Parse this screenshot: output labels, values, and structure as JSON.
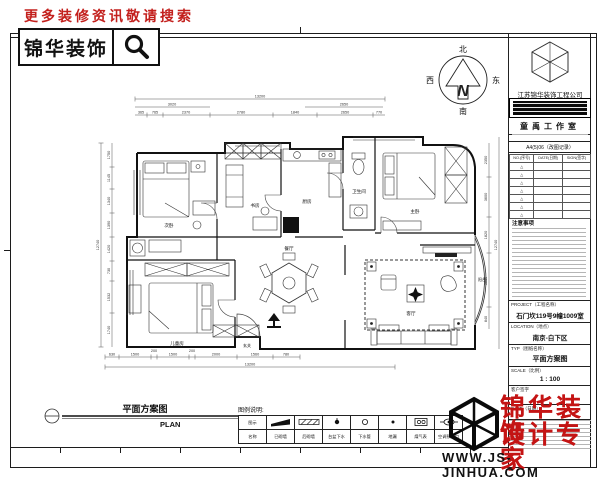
{
  "header": {
    "promo": "更多装修资讯敬请搜索",
    "brand": "锦华装饰"
  },
  "compass": {
    "north": "北",
    "south": "南",
    "east": "东",
    "west": "西",
    "letter": "N"
  },
  "titleblock": {
    "company": "江苏锦华装饰工程公司",
    "studio": "童禹工作室",
    "revision_title": "A4(5)06（改图记录）",
    "rev_headers": [
      "NO.(序号)",
      "DATE(日期)",
      "SIGN(签字)"
    ],
    "rev_mark": "△",
    "notes_title": "注意事项",
    "fields": [
      {
        "label": "PROJECT（工程名称）",
        "value": "石门坎119号9幢1009室"
      },
      {
        "label": "LOCATION（地点）",
        "value": "南京-白下区"
      },
      {
        "label": "TYP（图纸名称）",
        "value": "平面方案图"
      },
      {
        "label": "SCALE（比例）",
        "value": "1 : 100"
      },
      {
        "label": "客户签字",
        "value": ""
      },
      {
        "label": "DATE（日期）",
        "value": ""
      }
    ]
  },
  "plan": {
    "sheet_title": "平面方案图",
    "sheet_title_en": "PLAN",
    "rooms": {
      "bed2": "次卧",
      "study": "书房",
      "kitchen": "厨房",
      "bath": "卫生间",
      "master": "主卧",
      "balcony": "阳台",
      "child": "儿童房",
      "dining": "餐厅",
      "living": "客厅",
      "entry": "玄关"
    },
    "dims": {
      "top_total": "13200",
      "top_mid": [
        "3020",
        "2650"
      ],
      "top_segs": [
        "365",
        "765",
        "2370",
        "2780",
        "1840",
        "2650",
        "770"
      ],
      "left_total": "12740",
      "left_segs": [
        "1750",
        "1145",
        "1340",
        "1390",
        "1420",
        "730",
        "1532",
        "1740"
      ],
      "right_total": "12740",
      "right_segs": [
        "2350",
        "3600",
        "1820",
        "3610",
        "840"
      ],
      "bottom_total": "13200",
      "bottom_segs": [
        "630",
        "1500",
        "200",
        "1500",
        "200",
        "2000",
        "1560",
        "780"
      ]
    }
  },
  "legend": {
    "title": "图例说明:",
    "header_top": "图示",
    "header_bottom": "名称",
    "items": [
      {
        "name": "已砌墙"
      },
      {
        "name": "后砌墙"
      },
      {
        "name": "台盆下水"
      },
      {
        "name": "下水管"
      },
      {
        "name": "地漏"
      },
      {
        "name": "煤气表"
      },
      {
        "name": "空调预留口"
      }
    ]
  },
  "footer": {
    "brand_line1": "锦华装饰",
    "brand_line2": "设计专家",
    "url": "WWW.JS-JINHUA.COM"
  }
}
